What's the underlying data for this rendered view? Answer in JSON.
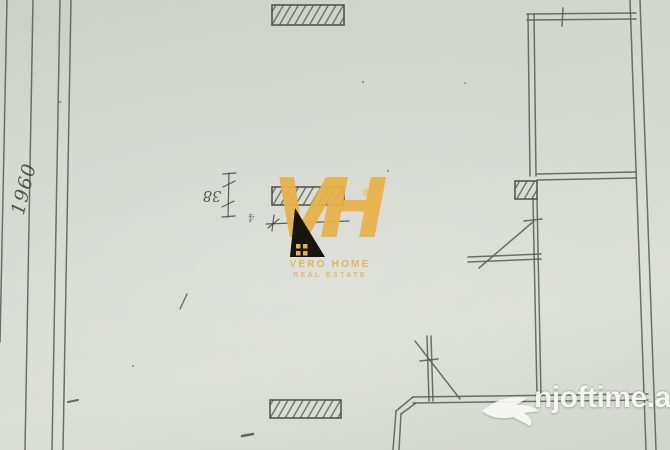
{
  "annotations": {
    "left_dimension": "1960",
    "wall_thickness": "38",
    "hand_mark_small": "4",
    "hand_mark_under_line": "47"
  },
  "watermarks": {
    "vero_home": {
      "monogram": "VH",
      "registered_symbol": "®",
      "name": "VERO HOME",
      "tagline": "REAL ESTATE"
    },
    "njoftime": {
      "site": "njoftime.al"
    }
  },
  "colors": {
    "paper": "#d6d9d2",
    "line": "#5b5e55",
    "hatch-border": "#4a4d45",
    "gold": "#e8b24b",
    "logo-black": "#18140e",
    "watermark-white": "#f8f9f5",
    "ink": "#3d4039"
  }
}
